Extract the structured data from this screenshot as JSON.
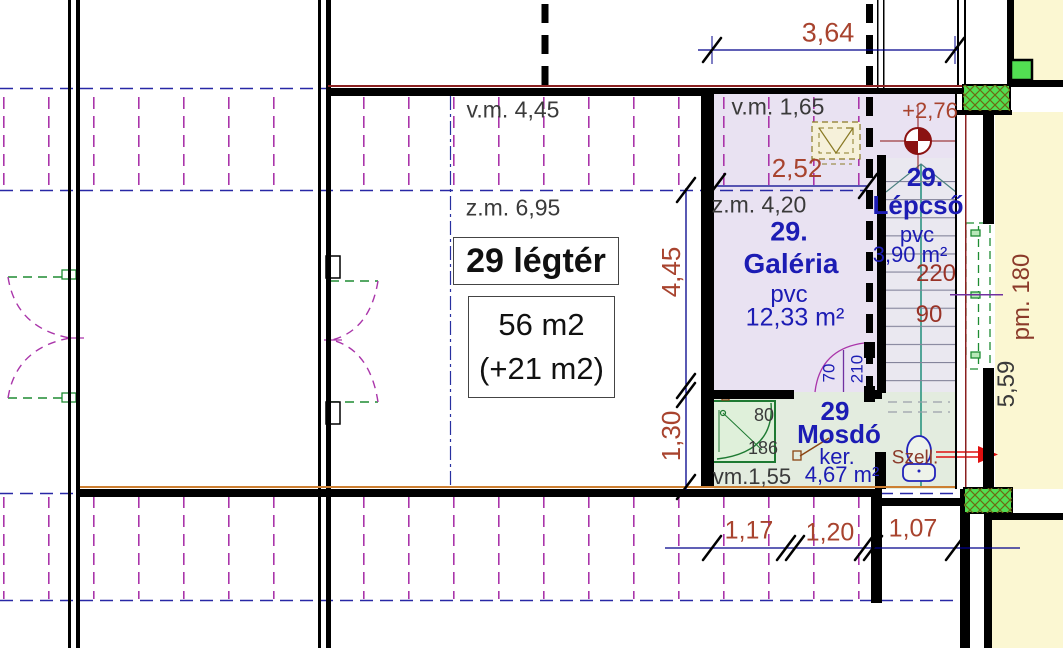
{
  "colors": {
    "wall": "#000000",
    "dim_line_blue": "#00008b",
    "dim_text_red": "#a8432e",
    "room_text_blue": "#1c1cb4",
    "note_text_gray": "#3a3a3a",
    "hatch_magenta": "#aa35aa",
    "roofline_blue": "#2828a6",
    "centerline_teal": "#00806a",
    "accent_orange": "#cd7f32",
    "vent_arrow_red": "#e01010",
    "level_marker_darkred": "#8b1212",
    "chimney_olive": "#8a7a25",
    "fill_lavender": "#e9e2f2",
    "fill_mint": "#e3ecdf",
    "fill_yellow": "#fbf7d2",
    "fill_green": "#52de52"
  },
  "rooms": {
    "legter": {
      "title": "29 légtér",
      "area": "56 m2",
      "area_extra": "(+21 m2)",
      "vm": "v.m. 4,45",
      "zm": "z.m. 6,95"
    },
    "galeria": {
      "number": "29.",
      "name": "Galéria",
      "floor": "pvc",
      "area": "12,33 m²",
      "vm": "v.m. 1,65",
      "zm": "z.m. 4,20",
      "width": "2,52"
    },
    "lepcso": {
      "number": "29.",
      "name": "Lépcső",
      "floor": "pvc",
      "area": "3,90 m²",
      "run": "220",
      "width": "90"
    },
    "mosdo": {
      "number": "29",
      "name": "Mosdó",
      "floor": "ker.",
      "area": "4,67 m²",
      "vm": "vm.1,55",
      "shower_width": "80",
      "shower_depth": "186",
      "vent": "Szell."
    }
  },
  "dims": {
    "top_width": "3,64",
    "room_height": "4,45",
    "lower_height": "1,30",
    "bottom_1": "1,17",
    "bottom_2": "1,20",
    "bottom_3": "1,07",
    "right_height": "5,59",
    "parapet": "pm. 180",
    "level": "+2,76",
    "door_width": "70",
    "door_height": "210"
  }
}
